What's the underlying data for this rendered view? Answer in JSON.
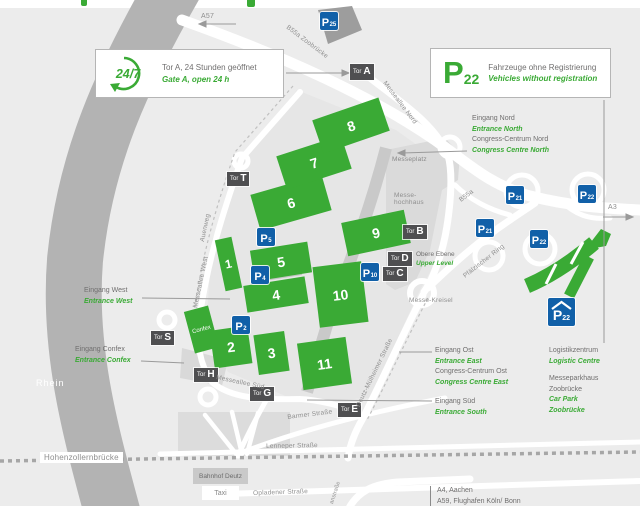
{
  "legend": {
    "hours_badge": "24/7",
    "gate_de": "Tor A, 24 Stunden geöffnet",
    "gate_en": "Gate A, open 24 h",
    "p_letter": "P",
    "p_number": "22",
    "p22_de": "Fahrzeuge ohne Registrierung",
    "p22_en": "Vehicles without registration"
  },
  "halls": {
    "numbers": [
      "1",
      "2",
      "3",
      "4",
      "5",
      "6",
      "7",
      "8",
      "9",
      "10",
      "11"
    ],
    "confex": "Confex"
  },
  "gates": {
    "prefix": "Tor",
    "letters": [
      "A",
      "T",
      "B",
      "D",
      "C",
      "S",
      "H",
      "G",
      "E"
    ]
  },
  "parking": {
    "p": "P",
    "subs": [
      "25",
      "5",
      "4",
      "2",
      "10",
      "21",
      "21",
      "22",
      "22"
    ],
    "car_park_sub": "22"
  },
  "streets": {
    "a57": "A57",
    "a3": "A3",
    "b55a_zoobruecke": "B55a Zoobrücke",
    "b55a": "B55a",
    "messeallee_nord": "Messeallee Nord",
    "auenweg": "Auenweg",
    "messeallee_west": "Messeallee West",
    "messeallee_sued": "Messeallee Süd",
    "deutz_muelheimer": "Deutz-Mülheimer Straße",
    "pfaelzischer_ring": "Pfälzischer Ring",
    "barmer": "Barmer Straße",
    "lenneper": "Lenneper Straße",
    "opladener": "Opladener Straße",
    "hohenzollernbruecke": "Hohenzollernbrücke",
    "rhein": "Rhein",
    "partial_street": "anstraße"
  },
  "places": {
    "messeplatz": "Messeplatz",
    "messehochhaus_1": "Messe-",
    "messehochhaus_2": "hochhaus",
    "messe_kreisel": "Messe-Kreisel",
    "obere_ebene_de": "Obere Ebene",
    "obere_ebene_en": "Upper Level",
    "bahnhof": "Bahnhof Deutz",
    "taxi": "Taxi"
  },
  "entrances": {
    "nord_de": "Eingang Nord",
    "nord_en": "Entrance North",
    "ccn_de": "Congress-Centrum Nord",
    "ccn_en": "Congress Centre North",
    "west_de": "Eingang West",
    "west_en": "Entrance West",
    "confex_de": "Eingang Confex",
    "confex_en": "Entrance Confex",
    "ost_de": "Eingang Ost",
    "ost_en": "Entrance East",
    "cco_de": "Congress-Centrum Ost",
    "cco_en": "Congress Centre East",
    "sued_de": "Eingang Süd",
    "sued_en": "Entrance South",
    "logistik_de": "Logistikzentrum",
    "logistik_en": "Logistic Centre",
    "parkhaus_de1": "Messeparkhaus",
    "parkhaus_de2": "Zoobrücke",
    "parkhaus_en1": "Car Park",
    "parkhaus_en2": "Zoobrücke"
  },
  "destinations": {
    "a4": "A4, Aachen",
    "a59": "A59, Flughafen Köln/ Bonn"
  },
  "colors": {
    "hall_green": "#3aaa35",
    "parking_blue": "#1160a8",
    "gate_gray": "#4f4f51",
    "text_gray": "#706f6f",
    "river_gray": "#b3b3b3",
    "road_white": "#ffffff"
  }
}
